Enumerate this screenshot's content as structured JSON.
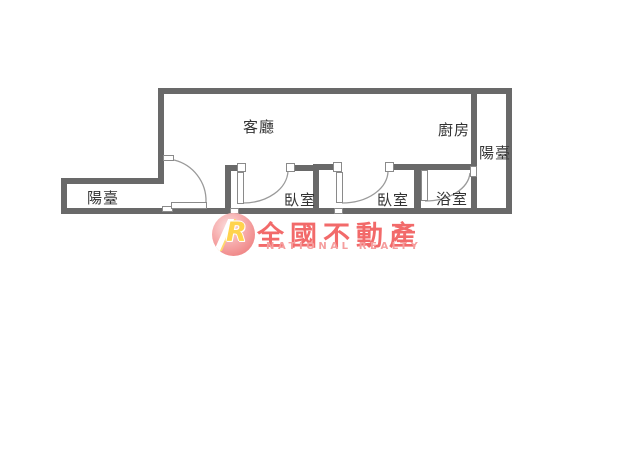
{
  "floor_plan": {
    "rooms": {
      "living_room": {
        "label": "客廳"
      },
      "kitchen": {
        "label": "廚房"
      },
      "balcony_left": {
        "label": "陽臺"
      },
      "balcony_right": {
        "label": "陽臺"
      },
      "bedroom_1": {
        "label": "臥室"
      },
      "bedroom_2": {
        "label": "臥室"
      },
      "bathroom": {
        "label": "浴室"
      }
    }
  },
  "watermark": {
    "logo_monogram": "R",
    "brand_name": "全國不動產",
    "brand_name_en": "NATIONAL REALTY"
  },
  "colors": {
    "wall_gray": "#696969",
    "door_outline_gray": "#8a8a8a",
    "label_text": "#333333",
    "brand_red": "#f26a6a",
    "brand_pink": "#f59e9e",
    "logo_circle_pink": "#f49090",
    "logo_monogram_yellow": "#ffd34d"
  }
}
